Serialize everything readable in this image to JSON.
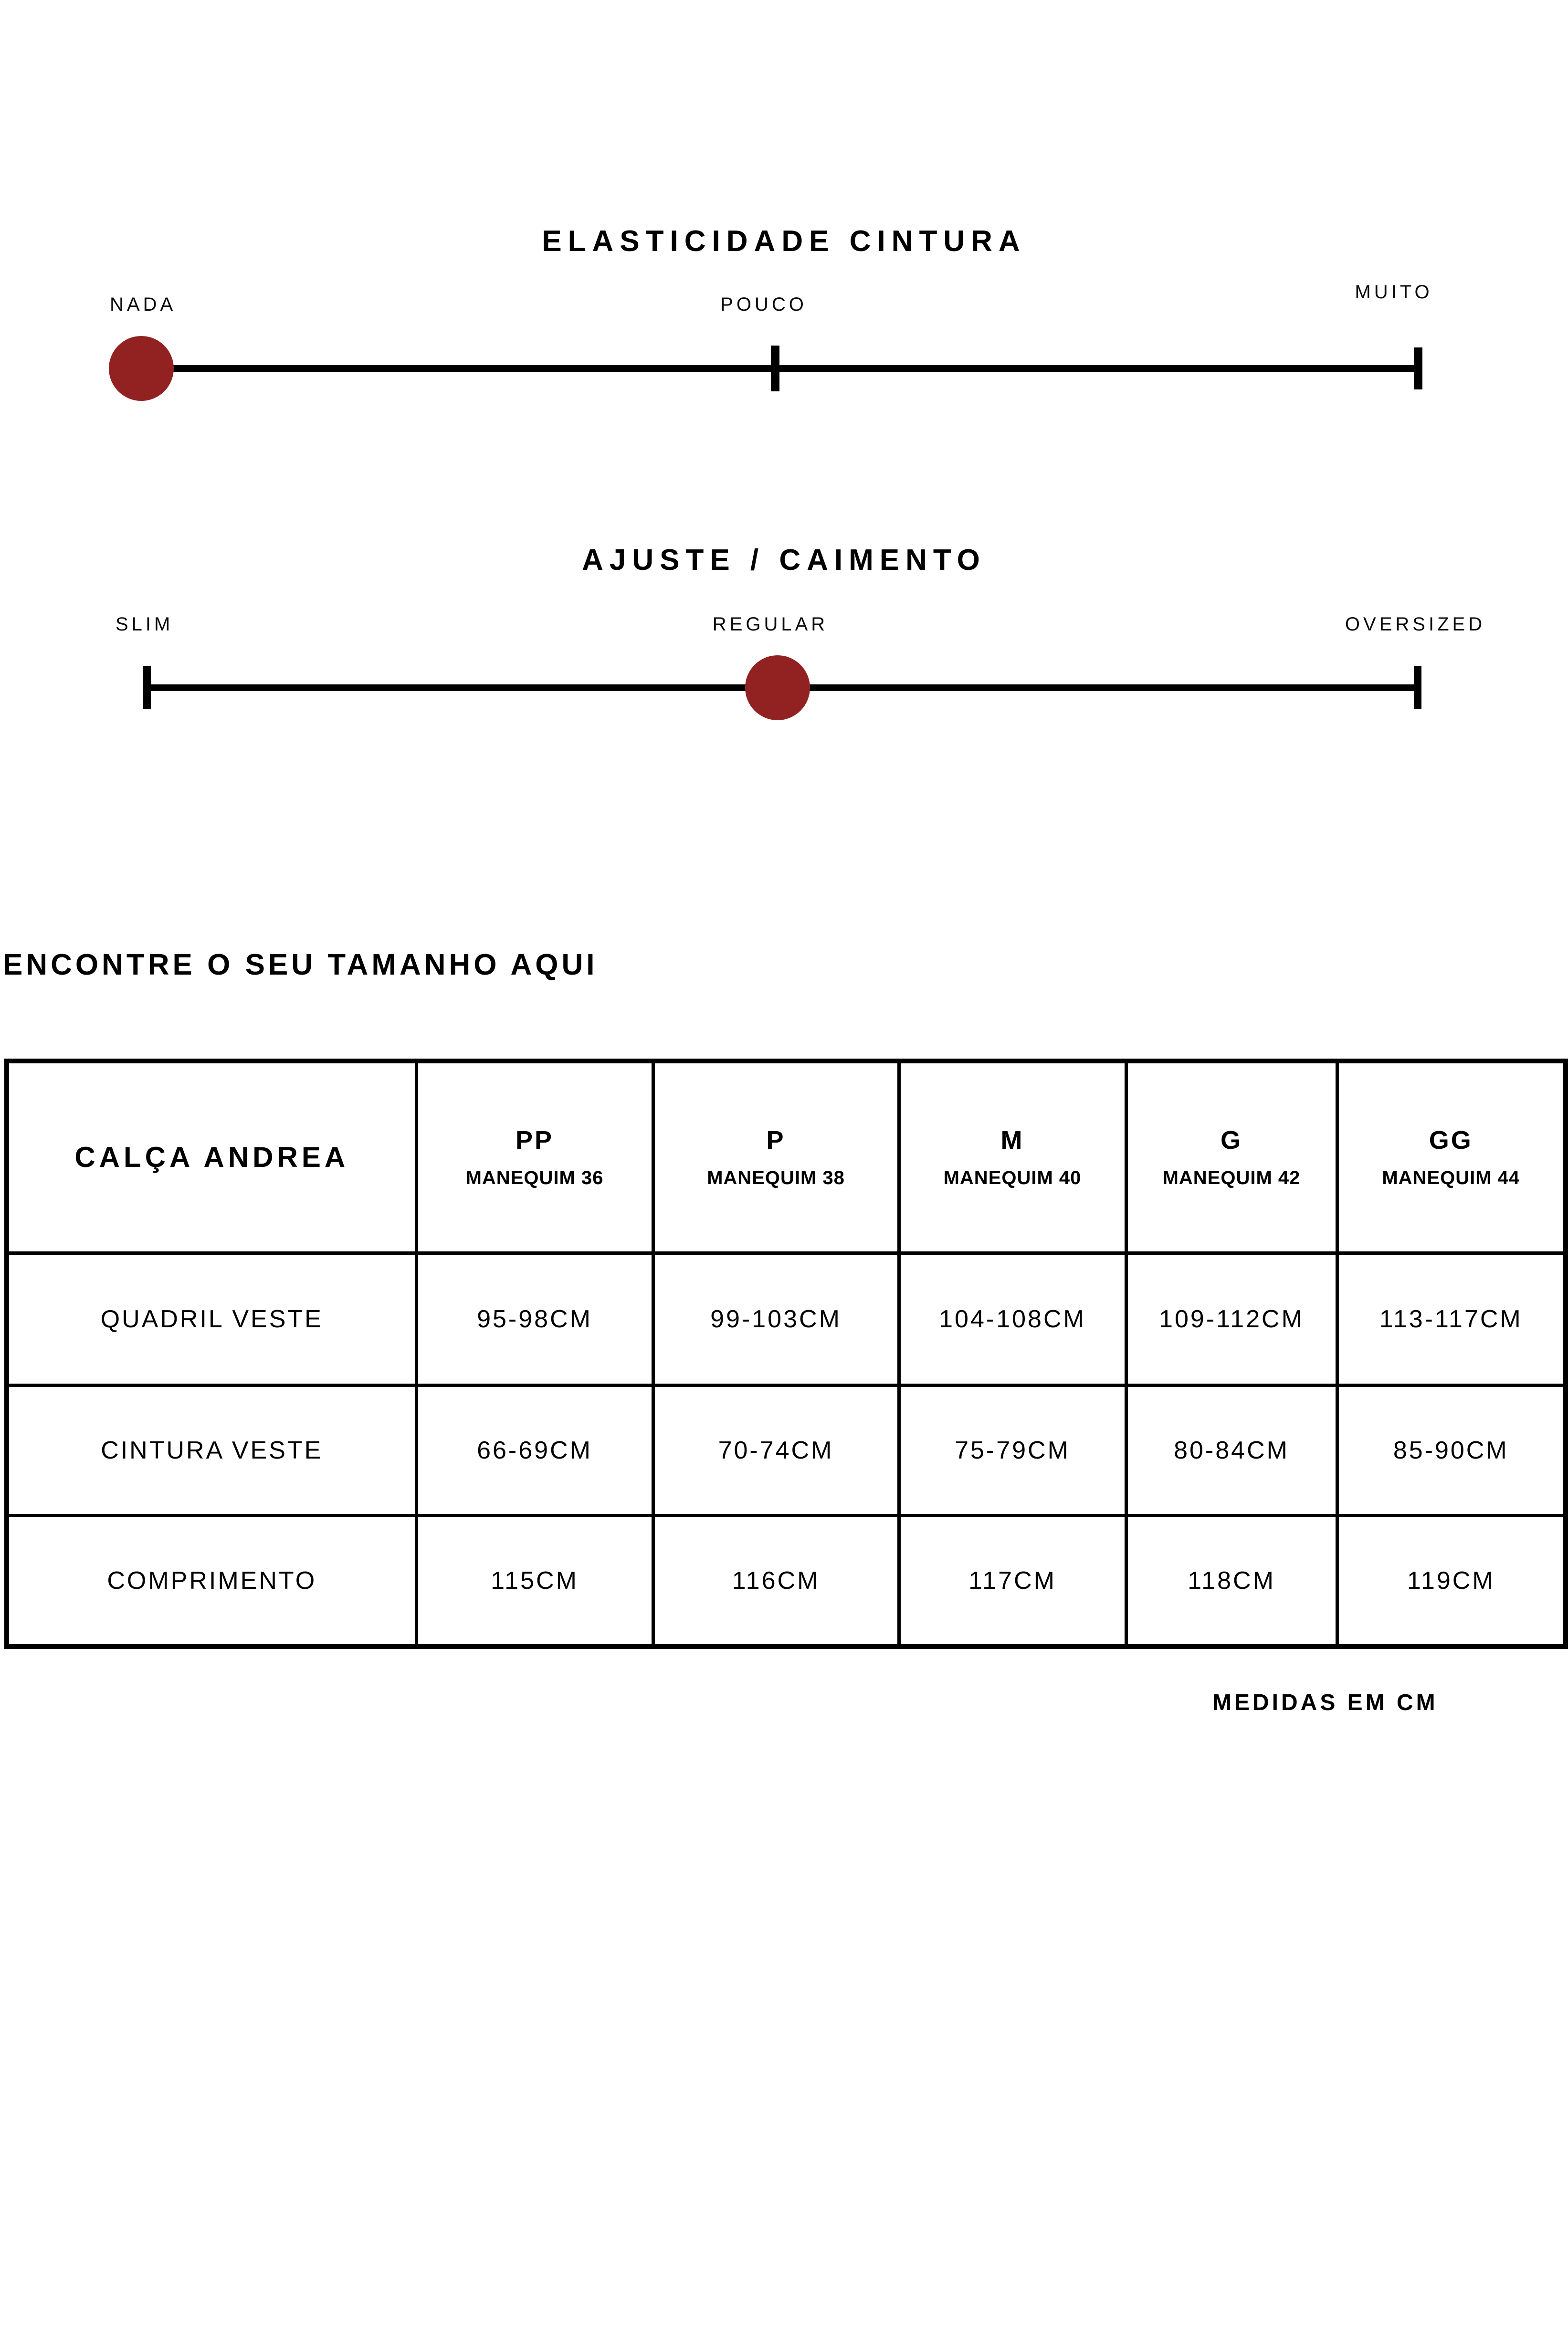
{
  "colors": {
    "background": "#ffffff",
    "text": "#000000",
    "accent_red": "#922222",
    "track": "#000000"
  },
  "sliders": [
    {
      "title": "ELASTICIDADE CINTURA",
      "left_label": "NADA",
      "center_label": "POUCO",
      "right_label": "MUITO",
      "selected_value": "NADA",
      "handle_position": "left"
    },
    {
      "title": "AJUSTE / CAIMENTO",
      "left_label": "SLIM",
      "center_label": "REGULAR",
      "right_label": "OVERSIZED",
      "selected_value": "REGULAR",
      "handle_position": "center"
    }
  ],
  "size_finder": {
    "heading": "ENCONTRE O SEU TAMANHO AQUI",
    "table": {
      "product": "CALÇA ANDREA",
      "size_columns": [
        {
          "size": "PP",
          "mannequin": "MANEQUIM 36"
        },
        {
          "size": "P",
          "mannequin": "MANEQUIM 38"
        },
        {
          "size": "M",
          "mannequin": "MANEQUIM 40"
        },
        {
          "size": "G",
          "mannequin": "MANEQUIM 42"
        },
        {
          "size": "GG",
          "mannequin": "MANEQUIM 44"
        }
      ],
      "rows": [
        {
          "label": "QUADRIL VESTE",
          "values": [
            "95-98CM",
            "99-103CM",
            "104-108CM",
            "109-112CM",
            "113-117CM"
          ]
        },
        {
          "label": "CINTURA VESTE",
          "values": [
            "66-69CM",
            "70-74CM",
            "75-79CM",
            "80-84CM",
            "85-90CM"
          ]
        },
        {
          "label": "COMPRIMENTO",
          "values": [
            "115CM",
            "116CM",
            "117CM",
            "118CM",
            "119CM"
          ]
        }
      ]
    },
    "footnote": "MEDIDAS EM CM"
  }
}
